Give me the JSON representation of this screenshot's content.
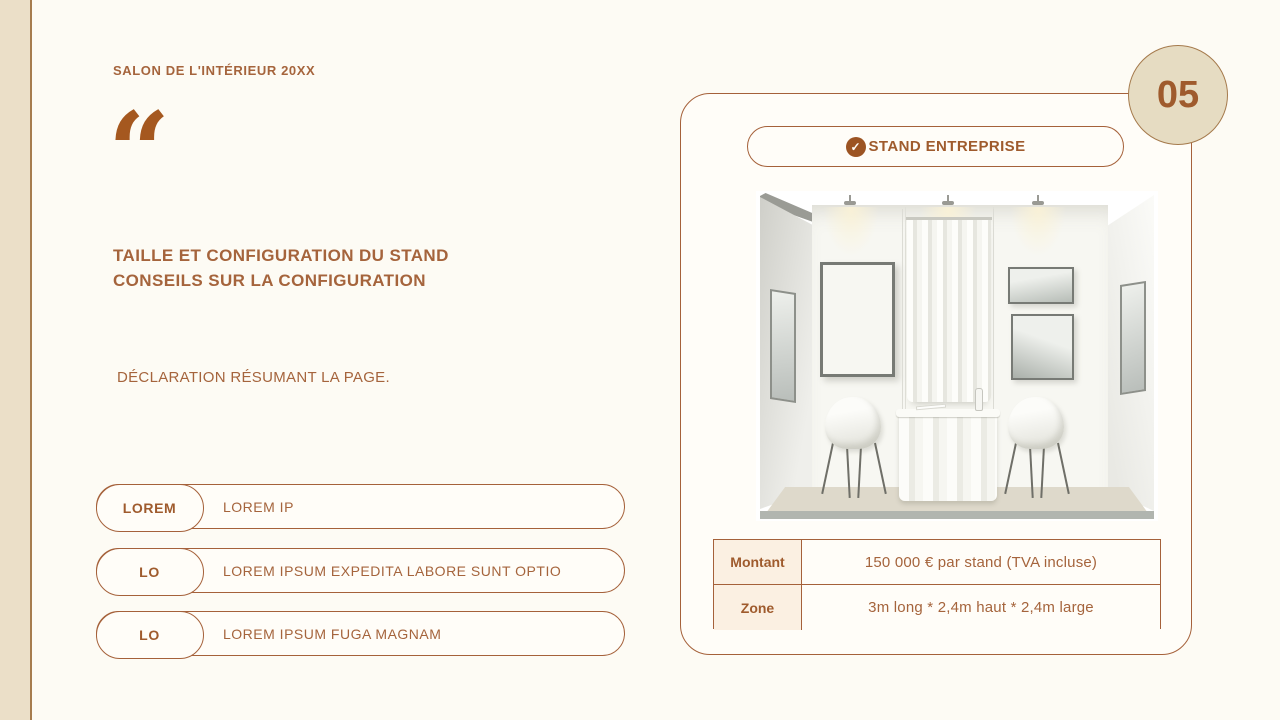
{
  "colors": {
    "accent": "#a5613a",
    "accent_dark": "#9c5423",
    "page_bg": "#fdfbf4",
    "sidebar_bg": "#ebdfc8",
    "badge_bg": "#e6dcc2",
    "table_label_bg": "#fbf0e2",
    "surface_bg": "#fffdf8"
  },
  "header": {
    "brand": "SALON DE L'INTÉRIEUR 20XX",
    "quote_icon": "“"
  },
  "main": {
    "title_line1": "TAILLE ET CONFIGURATION DU STAND",
    "title_line2": "CONSEILS SUR LA CONFIGURATION",
    "subtitle": "DÉCLARATION RÉSUMANT LA PAGE.",
    "list": [
      {
        "badge": "LOREM",
        "text": "LOREM IP"
      },
      {
        "badge": "LO",
        "text": "LOREM IPSUM EXPEDITA LABORE SUNT OPTIO"
      },
      {
        "badge": "LO",
        "text": "LOREM IPSUM FUGA MAGNAM"
      }
    ]
  },
  "card": {
    "title": "STAND ENTREPRISE",
    "check_icon": "✓",
    "table": {
      "rows": [
        {
          "label": "Montant",
          "value": "150 000 € par stand (TVA incluse)"
        },
        {
          "label": "Zone",
          "value": "3m long * 2,4m haut * 2,4m large"
        }
      ]
    }
  },
  "page_number": "05"
}
